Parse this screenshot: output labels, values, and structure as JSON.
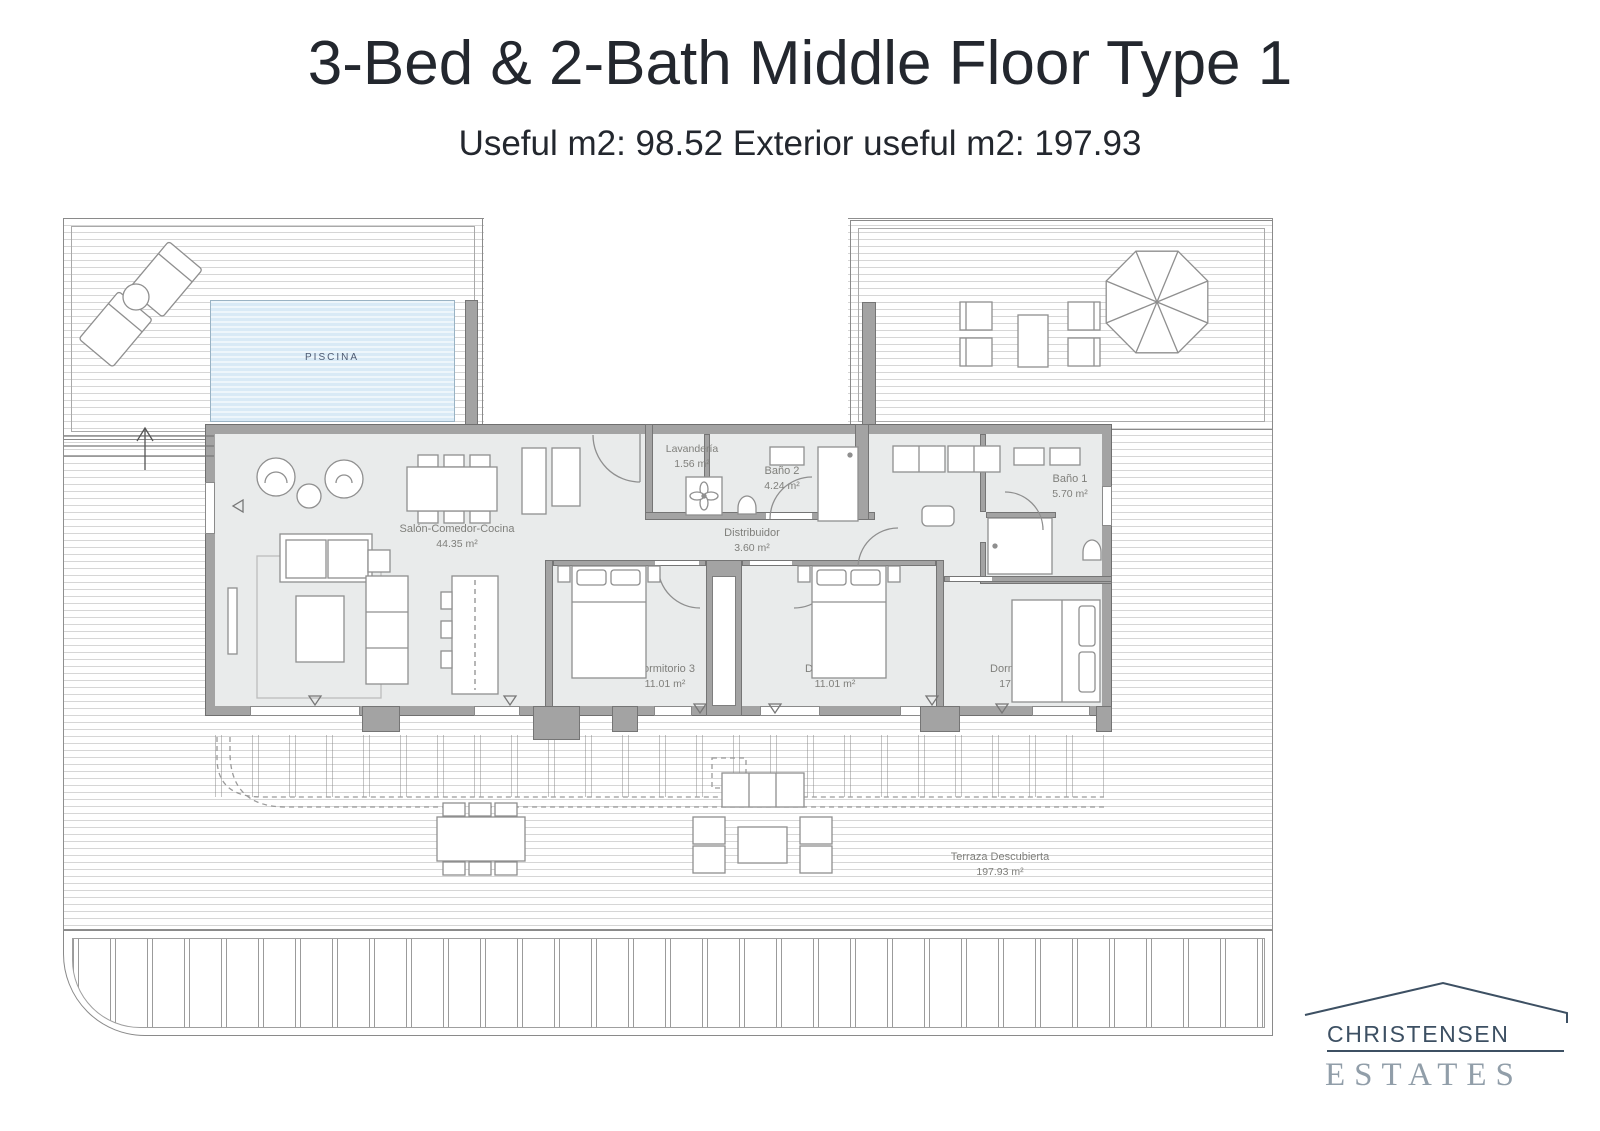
{
  "page": {
    "title": "3-Bed & 2-Bath Middle Floor Type 1",
    "subtitle": "Useful m2: 98.52 Exterior useful m2: 197.93"
  },
  "plan": {
    "pool_label": "PISCINA",
    "rooms": [
      {
        "id": "salon",
        "name": "Salón-Comedor-Cocina",
        "area": "44.35 m²"
      },
      {
        "id": "lavanderia",
        "name": "Lavandería",
        "area": "1.56 m²"
      },
      {
        "id": "bano2",
        "name": "Baño 2",
        "area": "4.24 m²"
      },
      {
        "id": "distribuidor",
        "name": "Distribuidor",
        "area": "3.60 m²"
      },
      {
        "id": "bano1",
        "name": "Baño 1",
        "area": "5.70 m²"
      },
      {
        "id": "dormitorio3",
        "name": "Dormitorio 3",
        "area": "11.01 m²"
      },
      {
        "id": "dormitorio2",
        "name": "Dormitorio 2",
        "area": "11.01 m²"
      },
      {
        "id": "dormitorio1",
        "name": "Dormitorio 1",
        "area": "17.06 m²"
      },
      {
        "id": "terraza",
        "name": "Terraza Descubierta",
        "area": "197.93 m²"
      }
    ]
  },
  "logo": {
    "line1": "CHRISTENSEN",
    "line2": "ESTATES"
  },
  "colors": {
    "wall": "#a3a3a3",
    "floor": "#e9ebeb",
    "pool": "#d9eaf6",
    "plan_line": "#8a8a8a",
    "label_text": "#7f7f7b",
    "pool_text": "#4d5a72",
    "title_text": "#23272e",
    "logo_dark": "#3d5063",
    "logo_light": "#919ea9"
  }
}
